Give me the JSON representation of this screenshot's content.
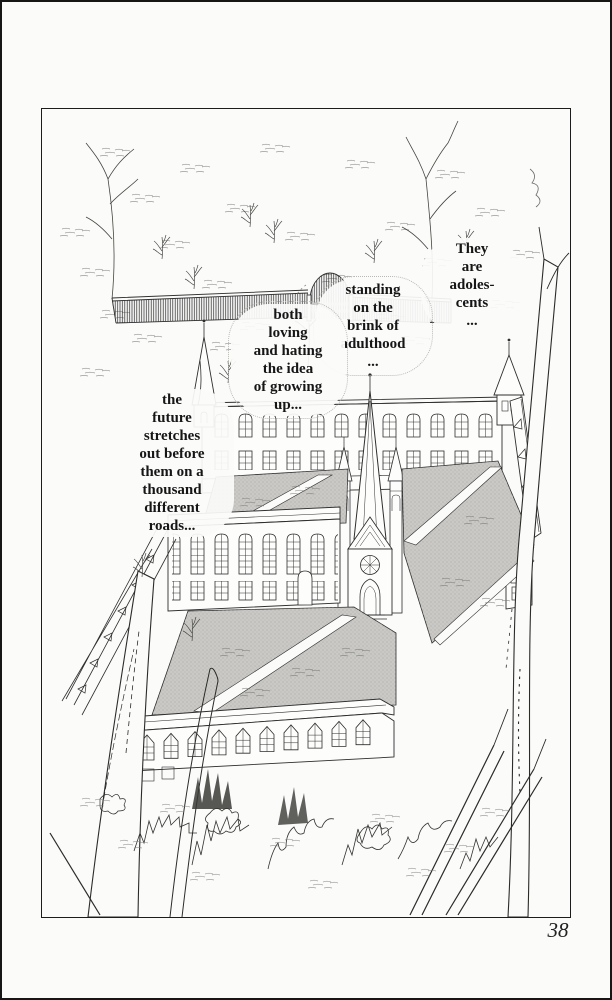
{
  "page": {
    "number": "38",
    "colors": {
      "paper": "#fbfbfa",
      "ink": "#2e2e2e",
      "courtyard_gray": "#cac9c6"
    }
  },
  "captions": {
    "they": "They\nare\nadoles-\ncents\n...",
    "standing": "standing\non the\nbrink of\nadulthood\n...",
    "both": "both\nloving\nand hating\nthe idea\nof growing\nup...",
    "future": "the\nfuture\nstretches\nout before\nthem on a\nthousand\ndifferent\nroads..."
  }
}
